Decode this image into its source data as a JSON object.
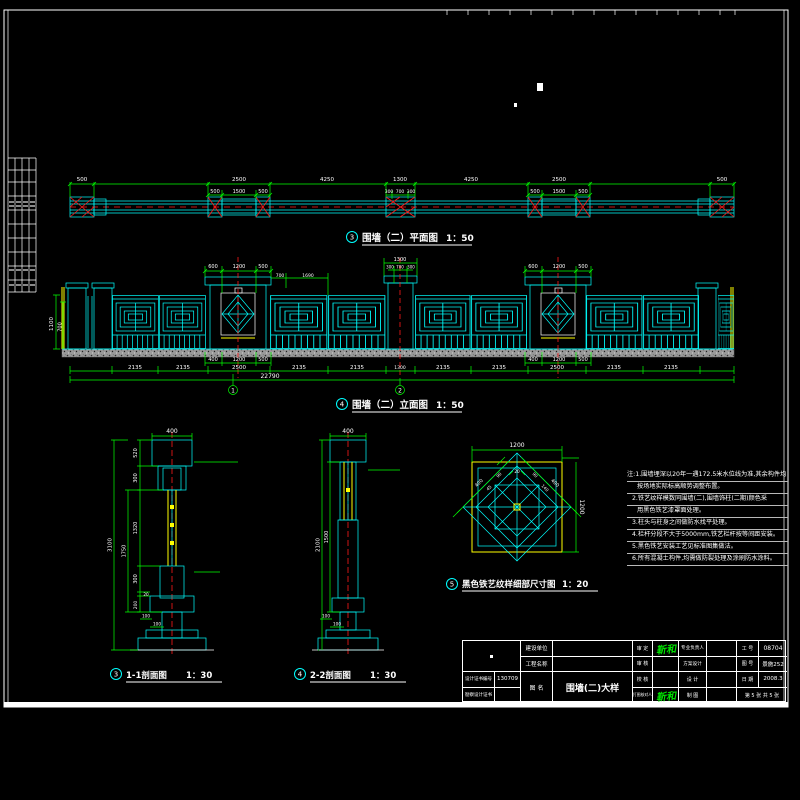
{
  "plan": {
    "badge": "3",
    "title": "围墙（二）平面图",
    "scale": "1：50",
    "t1": [
      "500",
      "2500",
      "4250",
      "1300",
      "4250",
      "2500",
      "500"
    ],
    "t2": [
      "500",
      "1500",
      "500",
      "300",
      "700",
      "300",
      "500",
      "1500",
      "500"
    ]
  },
  "elev": {
    "badge": "4",
    "title": "围墙（二）立面图",
    "scale": "1：50",
    "gtop": [
      "600",
      "1200",
      "500"
    ],
    "ptop": [
      "700",
      "1690"
    ],
    "ctop": [
      "1300",
      "300",
      "700",
      "300"
    ],
    "left": [
      "1100",
      "700"
    ],
    "gbot": [
      "400",
      "1200",
      "500"
    ],
    "panels": [
      "2135",
      "2135",
      "2500",
      "2135",
      "2135",
      "1300",
      "2135",
      "2135",
      "2500",
      "2135",
      "2135"
    ],
    "total": "22790",
    "cuts": [
      "1",
      "2"
    ]
  },
  "sec1": {
    "badge": "3",
    "title": "1-1剖面图",
    "scale": "1：30",
    "top": "400",
    "chain": [
      "520",
      "300",
      "1320",
      "300",
      "20",
      "200"
    ],
    "mid": "1750",
    "overall": "3100",
    "foot": [
      "100",
      "100"
    ]
  },
  "sec2": {
    "badge": "4",
    "title": "2-2剖面图",
    "scale": "1：30",
    "top": "400",
    "left": "2100",
    "left2": "1500",
    "foot": [
      "100",
      "100"
    ]
  },
  "detail": {
    "badge": "5",
    "title": "黑色铁艺纹样细部尺寸图",
    "scale": "1：20",
    "top": "1200",
    "right": "1200",
    "small": "20",
    "diag": [
      "400",
      "400",
      "90",
      "140",
      "90",
      "45"
    ]
  },
  "notes": {
    "lines": [
      "注:1.围墙埋深以20年一遇172.5米水位线为准,其余构件均",
      "按场地实际标高顺势调整布置。",
      "2.铁艺纹样模数同围墙(二),围墙饰柱(二期)颜色采",
      "用黑色铁艺漆罩面处理。",
      "3.柱头与柱身之间做防水找平处理。",
      "4.栏杆分段不大于5000mm,铁艺栏杆按等间距安装。",
      "5.黑色铁艺安装工艺见标准图集做法。",
      "6.所有混凝土构件,均需做防裂处理及涂刷防水涂料。"
    ]
  },
  "titleblock": {
    "cert_label": "设计证书编号",
    "cert_value": "130709",
    "cert2_label": "勘察设计证书",
    "cert2_value": "",
    "owner_label": "建设单位",
    "owner_value": "",
    "project_label": "工程名称",
    "project_value": "",
    "name_label": "图 名",
    "drawing_name": "围墙(二)大样",
    "r1": {
      "a": "审 定",
      "sig": "靳和",
      "b": "专业负责人",
      "bv": "",
      "c": "工 号",
      "cv": "08704"
    },
    "r2": {
      "a": "审 核",
      "sig": "",
      "b": "方案设计",
      "bv": "",
      "c": "图 号",
      "cv": "景施252"
    },
    "r3": {
      "a": "校 核",
      "sig": "",
      "b": "设 计",
      "bv": "",
      "c": "日 期",
      "cv": "2008.3"
    },
    "r4": {
      "a": "打图核对人",
      "sig": "靳和",
      "b": "制 图",
      "bv": "",
      "sheet": "第 5 张 共 5 张"
    }
  }
}
